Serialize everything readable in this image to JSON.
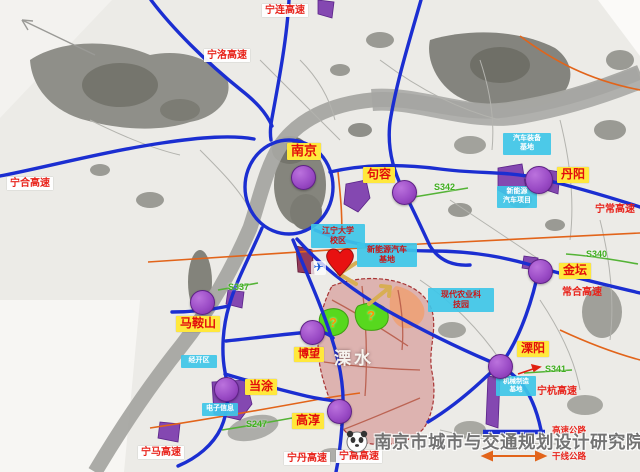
{
  "watermark": {
    "text": "南京市城市与交通规划设计研究院",
    "logo": "panda-logo"
  },
  "legend": {
    "expressway": "高速公路",
    "trunk_road": "干线公路"
  },
  "cities": [
    {
      "name": "nanjing",
      "label": "南京"
    },
    {
      "name": "jurong",
      "label": "句容"
    },
    {
      "name": "danyang",
      "label": "丹阳"
    },
    {
      "name": "jintan",
      "label": "金坛"
    },
    {
      "name": "liyang",
      "label": "溧阳"
    },
    {
      "name": "maanshan",
      "label": "马鞍山"
    },
    {
      "name": "bowang",
      "label": "博望"
    },
    {
      "name": "dangtu",
      "label": "当涂"
    },
    {
      "name": "gaochun",
      "label": "高淳"
    }
  ],
  "district": {
    "label": "溧水"
  },
  "expressways": [
    {
      "name": "ninglian",
      "label": "宁连高速"
    },
    {
      "name": "ningluo",
      "label": "宁洛高速"
    },
    {
      "name": "ninghe",
      "label": "宁合高速"
    },
    {
      "name": "ningma",
      "label": "宁马高速"
    },
    {
      "name": "ningdan",
      "label": "宁丹高速"
    },
    {
      "name": "ninggao",
      "label": "宁高高速"
    },
    {
      "name": "ningchang",
      "label": "宁常高速"
    },
    {
      "name": "changhe",
      "label": "常合高速"
    },
    {
      "name": "ninghang",
      "label": "宁杭高速"
    }
  ],
  "routes": [
    {
      "label": "S342"
    },
    {
      "label": "S340"
    },
    {
      "label": "S341"
    },
    {
      "label": "S337"
    },
    {
      "label": "S247"
    }
  ],
  "info_boxes": [
    {
      "name": "danyang-auto",
      "line1": "汽车装备",
      "line2": "基地"
    },
    {
      "name": "danyang-nev",
      "line1": "新能源",
      "line2": "汽车项目"
    },
    {
      "name": "campus",
      "line1": "江宁大学",
      "line2": "校区"
    },
    {
      "name": "nev-base",
      "line1": "新能源汽车",
      "line2": "基地"
    },
    {
      "name": "agri-park",
      "line1": "现代农业科",
      "line2": "技园"
    },
    {
      "name": "liyang-machinery",
      "line1": "机械制造",
      "line2": "基地"
    },
    {
      "name": "maanshan-zone",
      "line1": "经开区",
      "line2": ""
    },
    {
      "name": "dangtu-electronics",
      "line1": "电子信息",
      "line2": ""
    }
  ],
  "markers": {
    "question": "?",
    "airplane": "✈"
  }
}
